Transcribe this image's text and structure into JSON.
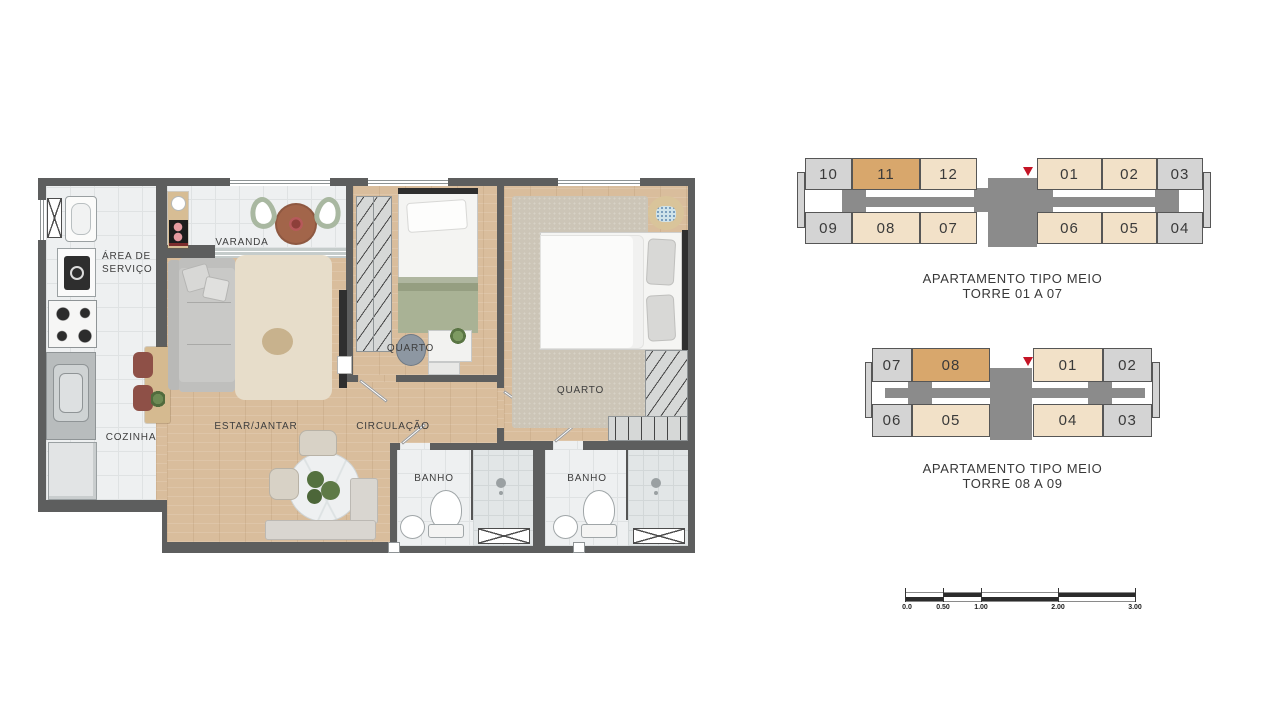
{
  "floor_plan": {
    "labels": {
      "area_servico_l1": "ÁREA DE",
      "area_servico_l2": "SERVIÇO",
      "varanda": "VARANDA",
      "cozinha": "COZINHA",
      "estar_jantar": "ESTAR/JANTAR",
      "circulacao": "CIRCULAÇÃO",
      "quarto_1": "QUARTO",
      "quarto_2": "QUARTO",
      "banho_1": "BANHO",
      "banho_2": "BANHO"
    }
  },
  "key_plans": [
    {
      "title_line1": "APARTAMENTO TIPO MEIO",
      "title_line2": "TORRE 01 A 07",
      "top_units": [
        {
          "num": "10",
          "style": "gray"
        },
        {
          "num": "11",
          "style": "highlight"
        },
        {
          "num": "12",
          "style": "tan"
        },
        {
          "num": "01",
          "style": "tan"
        },
        {
          "num": "02",
          "style": "tan"
        },
        {
          "num": "03",
          "style": "gray"
        }
      ],
      "bottom_units": [
        {
          "num": "09",
          "style": "gray"
        },
        {
          "num": "08",
          "style": "tan"
        },
        {
          "num": "07",
          "style": "tan"
        },
        {
          "num": "06",
          "style": "tan"
        },
        {
          "num": "05",
          "style": "tan"
        },
        {
          "num": "04",
          "style": "gray"
        }
      ]
    },
    {
      "title_line1": "APARTAMENTO TIPO MEIO",
      "title_line2": "TORRE 08 A 09",
      "top_units": [
        {
          "num": "07",
          "style": "gray"
        },
        {
          "num": "08",
          "style": "highlight"
        },
        {
          "num": "01",
          "style": "tan"
        },
        {
          "num": "02",
          "style": "gray"
        }
      ],
      "bottom_units": [
        {
          "num": "06",
          "style": "gray"
        },
        {
          "num": "05",
          "style": "tan"
        },
        {
          "num": "04",
          "style": "tan"
        },
        {
          "num": "03",
          "style": "gray"
        }
      ]
    }
  ],
  "scale_bar": {
    "labels": [
      "0.0",
      "0.50",
      "1.00",
      "2.00",
      "3.00"
    ]
  },
  "colors": {
    "unit_tan": "#f2e1c8",
    "unit_highlight": "#d8a76c",
    "unit_gray": "#d4d4d4",
    "core_gray": "#8b8b8b",
    "marker_red": "#c41425",
    "wall": "#5d5e5e",
    "wood_floor": "#d9bd9c",
    "tile": "#eef0f1"
  }
}
